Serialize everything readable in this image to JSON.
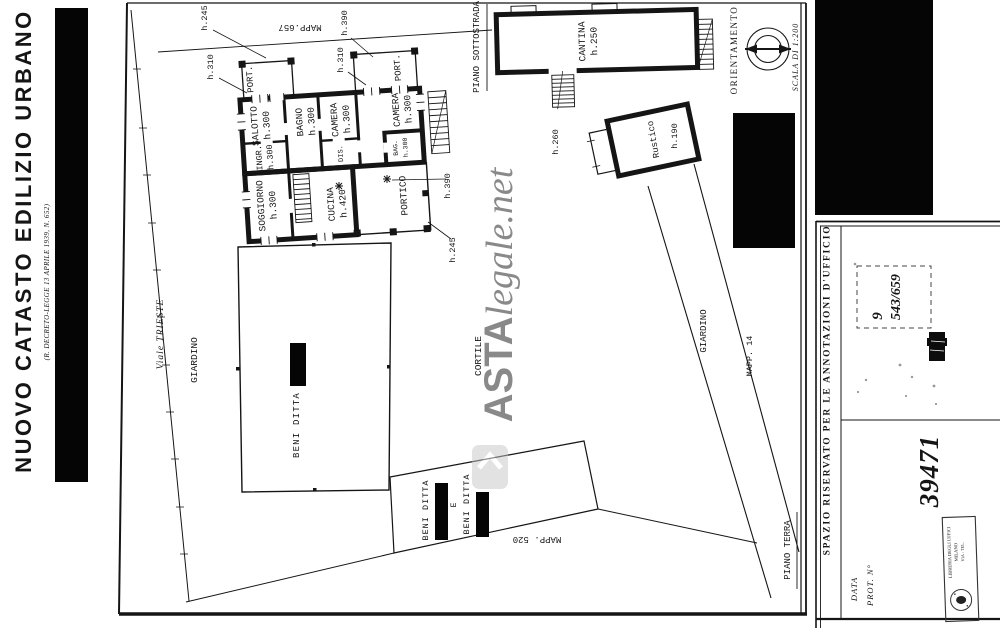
{
  "colors": {
    "paper": "#ffffff",
    "ink": "#151515",
    "watermark": "#bcbcbc",
    "redaction": "#050505"
  },
  "header": {
    "title": "NUOVO CATASTO EDILIZIO URBANO",
    "subtitle": "(R. DECRETO-LEGGE 13 APRILE 1939, N. 652)"
  },
  "watermark": {
    "bold": "ASTA",
    "rest": "legale.net"
  },
  "plan": {
    "floors": {
      "sottostrada": "PIANO SOTTOSTRADA",
      "terra": "PIANO TERRA"
    },
    "compass": {
      "label": "ORIENTAMENTO",
      "scale": "SCALA DI 1:200"
    },
    "street": "Viale TRIESTE",
    "areas": {
      "giardino_left": "GIARDINO",
      "cortile": "CORTILE",
      "giardino_right": "GIARDINO"
    },
    "maps": {
      "m657": "MAPP.657",
      "m520": "MAPP. 520",
      "m14": "MAPP. 14"
    },
    "rooms": {
      "port1": "PORT.",
      "port2": "PORT.",
      "salotto": {
        "n": "SALOTTO",
        "h": "h.300"
      },
      "ingr": {
        "n": "INGR.",
        "h": "h.300"
      },
      "bagno": {
        "n": "BAGNO",
        "h": "h.300"
      },
      "camera1": {
        "n": "CAMERA",
        "h": "h.300"
      },
      "camera2": {
        "n": "CAMERA",
        "h": "h.300"
      },
      "dis": "DIS.",
      "bag": {
        "n": "BAG.",
        "h": "h.300"
      },
      "soggiorno": {
        "n": "SOGGIORNO",
        "h": "h.300"
      },
      "cucina": {
        "n": "CUCINA",
        "h": "h.420"
      },
      "portico": "PORTICO",
      "cantina": {
        "n": "CANTINA",
        "h": "h.250"
      },
      "rustico": {
        "n": "Rustico",
        "h1": "h.260",
        "h2": "h.190"
      }
    },
    "dims": {
      "a": "h.245",
      "b": "h.310",
      "c": "h.390",
      "d": "h.310",
      "e": "h.390",
      "f": "h.245"
    },
    "owners": {
      "beni": "BENI DITTA",
      "conj": "E"
    }
  },
  "panel": {
    "reserved": "SPAZIO RISERVATO PER LE ANNOTAZIONI D'UFFICIO",
    "handwritten": {
      "n9": "9",
      "fraction": "543/659",
      "protocol": "39471"
    },
    "fields": {
      "data": "DATA",
      "prot": "PROT. N°"
    },
    "stamp": {
      "l1": "LIBRERIA DEGLI UFFICI",
      "l2": "MILANO",
      "l3": "VIA - TEL."
    }
  }
}
